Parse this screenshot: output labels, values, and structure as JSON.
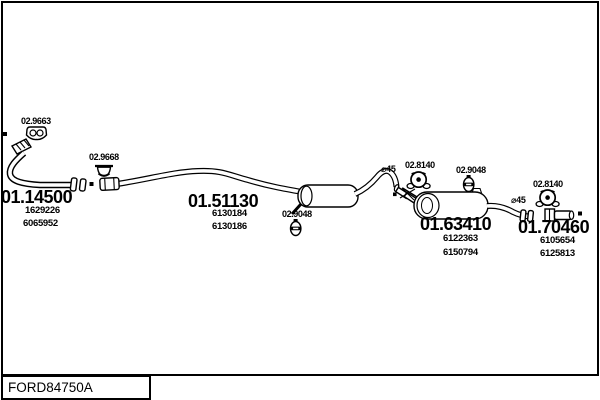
{
  "footer": {
    "drawing_id": "FORD84750A"
  },
  "parts": {
    "front_pipe": {
      "part_number": "01.14500",
      "oe1": "1629226",
      "oe2": "6065952"
    },
    "mid_pipe": {
      "part_number": "01.51130",
      "oe1": "6130184",
      "oe2": "6130186"
    },
    "rear_muffler": {
      "part_number": "01.63410",
      "oe1": "6122363",
      "oe2": "6150794"
    },
    "tail_pipe": {
      "part_number": "01.70460",
      "oe1": "6105654",
      "oe2": "6125813"
    }
  },
  "mountings": {
    "bracket_front": {
      "code": "02.9663",
      "icon": "two-hole-bracket-icon"
    },
    "clamp_front": {
      "code": "02.9668",
      "icon": "dome-clamp-icon"
    },
    "hanger_mid": {
      "code": "02.9048",
      "icon": "oval-hanger-icon"
    },
    "ring_rear": {
      "code": "02.8140",
      "icon": "ring-hanger-icon"
    },
    "hanger_rear": {
      "code": "02.9048",
      "icon": "oval-hanger-icon"
    },
    "ring_tail": {
      "code": "02.8140",
      "icon": "ring-hanger-icon"
    }
  },
  "dimensions": {
    "mid_pipe_diameter": "⌀45",
    "tail_pipe_diameter": "⌀45"
  },
  "colors": {
    "line": "#000000",
    "background": "#ffffff"
  }
}
